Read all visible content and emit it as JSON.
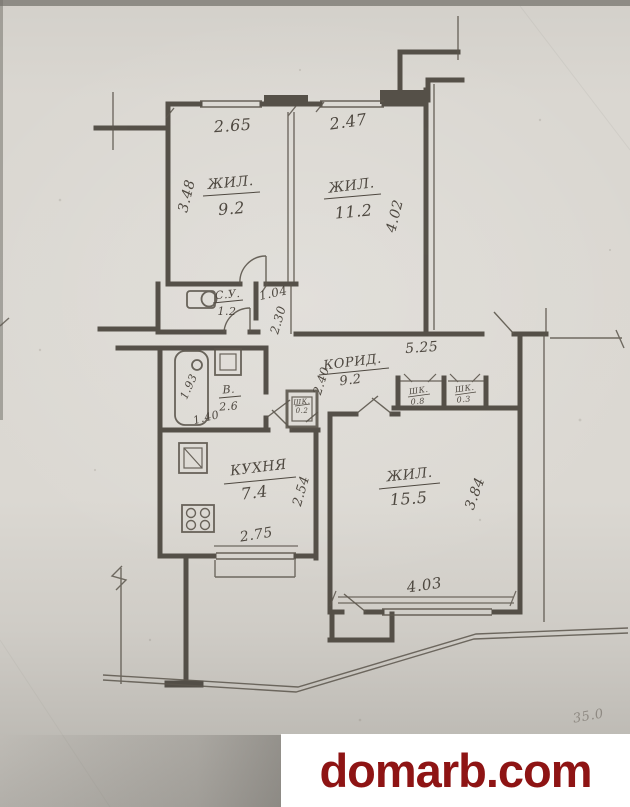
{
  "paper": {
    "background": "#dad7d1",
    "ink": "#4a453d",
    "shadow": "#aeaba6"
  },
  "plan": {
    "rooms": {
      "living1": {
        "label": "ЖИЛ.",
        "area": "9.2",
        "width": "2.65",
        "height": "3.48"
      },
      "living2": {
        "label": "ЖИЛ.",
        "area": "11.2",
        "width": "2.47",
        "height": "4.02"
      },
      "wc": {
        "label": "С.У.",
        "area": "1.2"
      },
      "bathroom": {
        "label": "В.",
        "area": "2.6",
        "width": "1.40",
        "height": "1.93"
      },
      "corridor": {
        "label": "КОРИД.",
        "area": "9.2",
        "width": "5.25",
        "height": "2.40"
      },
      "kitchen": {
        "label": "КУХНЯ",
        "area": "7.4",
        "width": "2.75",
        "height": "2.54"
      },
      "living3": {
        "label": "ЖИЛ.",
        "area": "15.5",
        "width": "4.03",
        "height": "3.84"
      },
      "closet1": {
        "label": "ШК.",
        "area": "0.8"
      },
      "closet2": {
        "label": "ШК.",
        "area": "0.3"
      },
      "closet3": {
        "label": "ШК.",
        "area": "0.2"
      }
    },
    "openings": {
      "door_width": "1.04",
      "hall_depth": "2.30"
    },
    "pencil_note": "35.0"
  },
  "watermark": {
    "text": "domarb.com",
    "color": "#8e1414",
    "panel": "#ffffff"
  }
}
